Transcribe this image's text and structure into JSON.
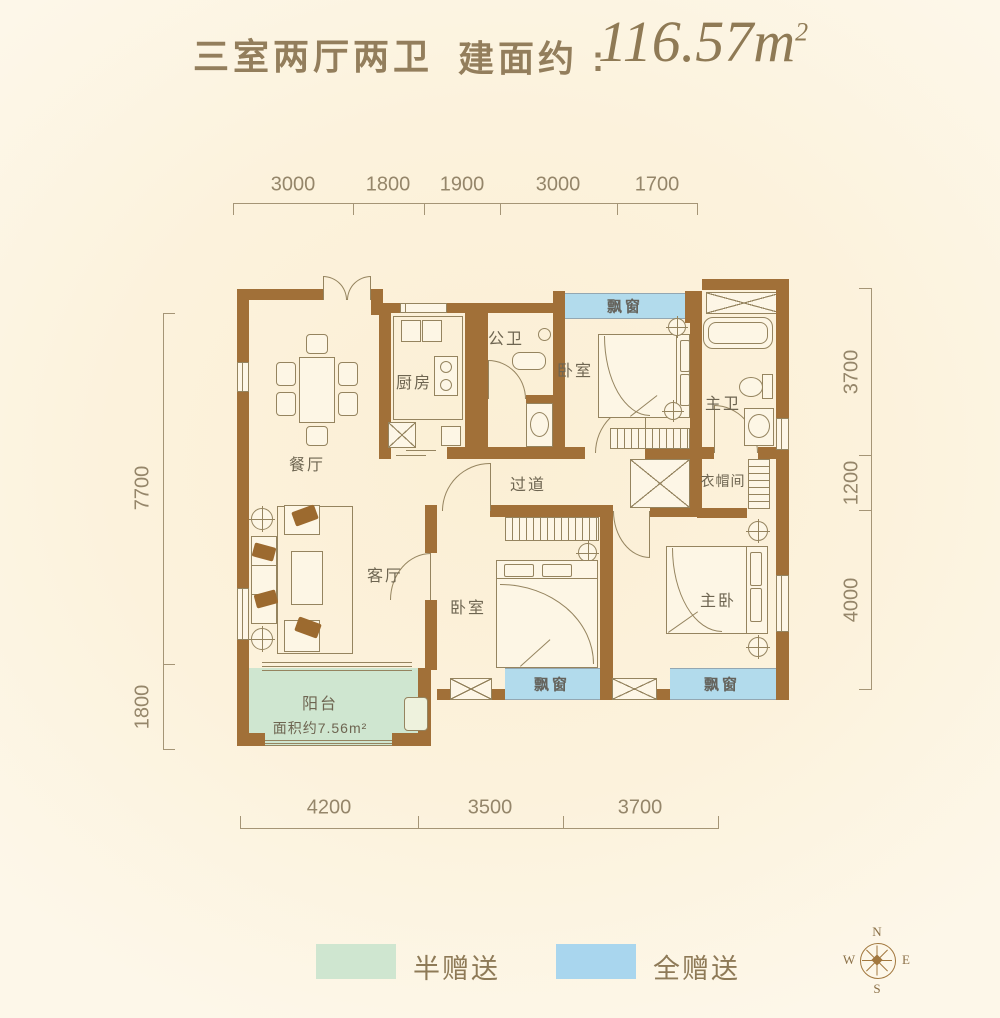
{
  "header": {
    "layout_type": "三室两厅两卫",
    "area_prefix": "建面约 : ",
    "area_number": "116.57",
    "area_unit": "m",
    "area_exponent": "2"
  },
  "plan": {
    "rooms": {
      "dining": "餐厅",
      "kitchen": "厨房",
      "public_bath": "公卫",
      "bedroom_top": "卧室",
      "master_bath": "主卫",
      "cloakroom": "衣帽间",
      "corridor": "过道",
      "living": "客厅",
      "bedroom_bottom": "卧室",
      "master_bedroom": "主卧",
      "balcony": "阳台",
      "balcony_area": "面积约7.56m²"
    },
    "bay_window": "飘窗"
  },
  "dimensions": {
    "top": [
      "3000",
      "1800",
      "1900",
      "3000",
      "1700"
    ],
    "bottom": [
      "4200",
      "3500",
      "3700"
    ],
    "left": [
      "7700",
      "1800"
    ],
    "right": [
      "3700",
      "1200",
      "4000"
    ]
  },
  "legend": [
    {
      "label": "半赠送",
      "color": "#cfe6d0"
    },
    {
      "label": "全赠送",
      "color": "#a9d6ee"
    }
  ],
  "compass": {
    "north": "N",
    "south": "S",
    "east": "E",
    "west": "W"
  },
  "colors": {
    "wall": "#a17038",
    "background": "#fcf2dc",
    "bay_window_fill": "#b2dbec",
    "balcony_fill": "#cfe6d0",
    "line": "#95845f",
    "title_text": "#937e5c",
    "dimension_text": "#95866a"
  }
}
